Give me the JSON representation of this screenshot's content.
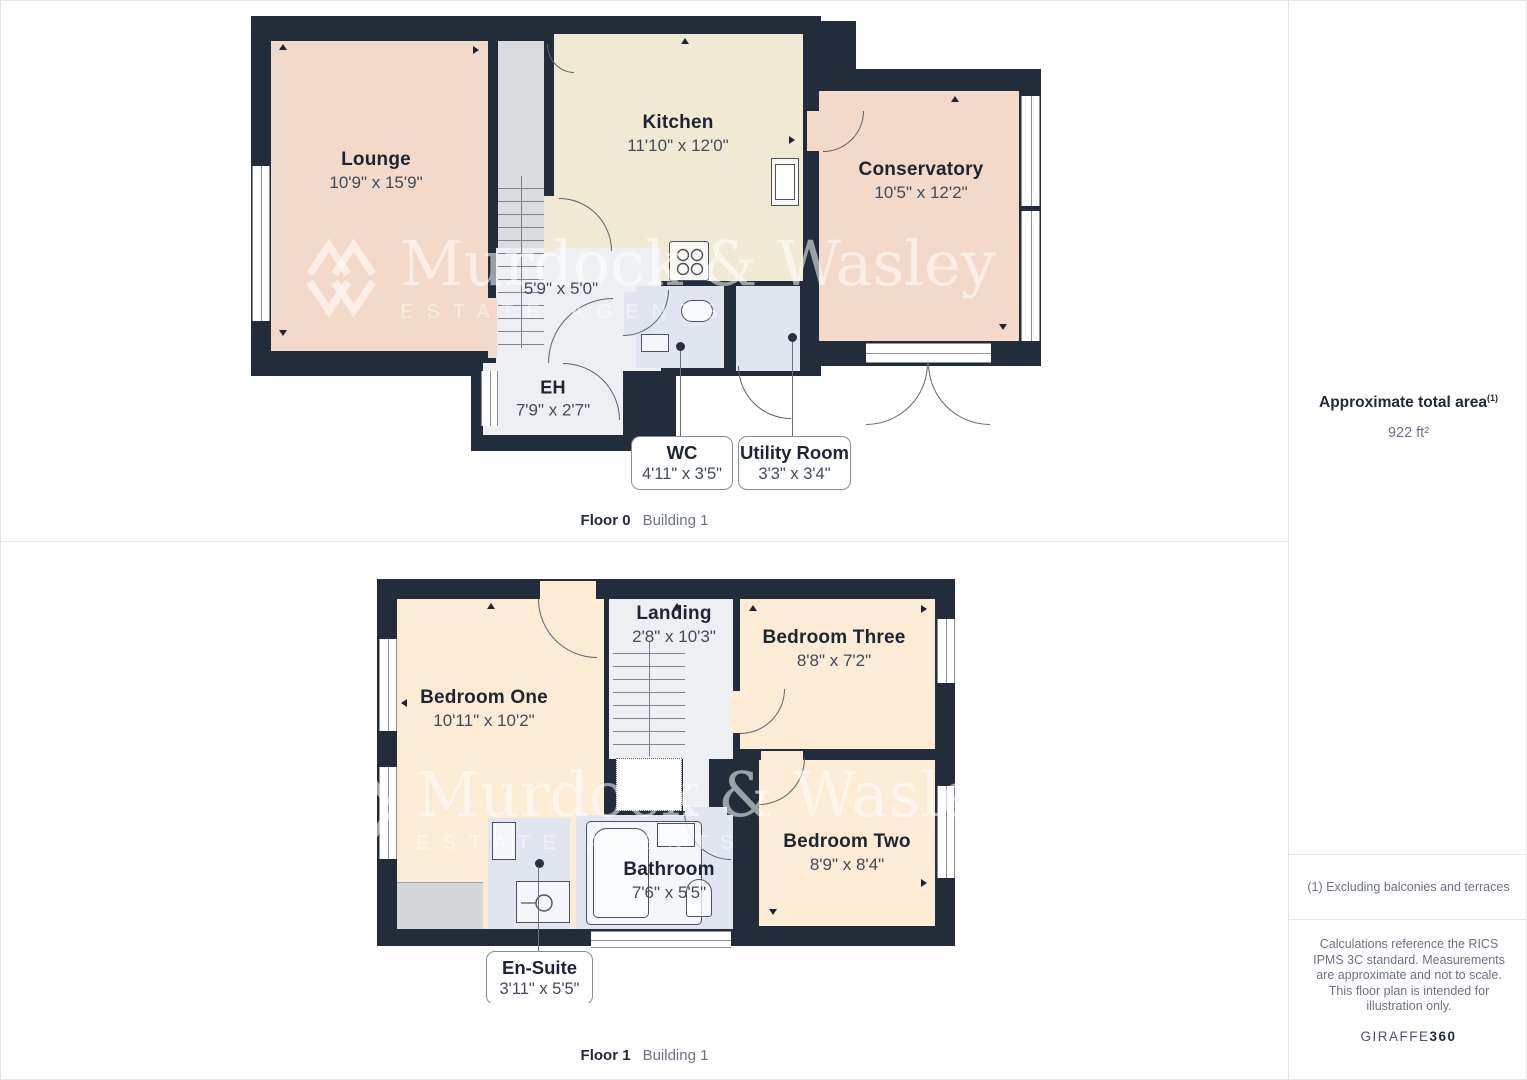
{
  "colors": {
    "wall": "#232C3B",
    "pink": "#F3D9C9",
    "cream": "#F0EAD4",
    "peach": "#FCEBD5",
    "room-gray": "#EDEFF2",
    "room-blue": "#E0E5F0",
    "stair-gray": "#D9DBDE",
    "wardrobe-gray": "#D4D6D9",
    "label-navy": "#1D2534",
    "label-dim": "#414B5A",
    "muted": "#6B7280",
    "line": "#E3E5E7",
    "door-line": "#5B6472",
    "fix-line": "#4A5264"
  },
  "watermark": {
    "name": "Murdock & Wasley",
    "subtitle": "ESTATE AGENTS"
  },
  "floor0": {
    "caption": "Floor 0",
    "building": "Building 1",
    "rooms": {
      "lounge": {
        "name": "Lounge",
        "dims": "10'9\" x 15'9\""
      },
      "kitchen": {
        "name": "Kitchen",
        "dims": "11'10\" x 12'0\""
      },
      "conservatory": {
        "name": "Conservatory",
        "dims": "10'5\" x 12'2\""
      },
      "hall": {
        "dims": "5'9\" x 5'0\""
      },
      "eh": {
        "name": "EH",
        "dims": "7'9\" x 2'7\""
      },
      "wc": {
        "name": "WC",
        "dims": "4'11\" x 3'5\""
      },
      "utility": {
        "name": "Utility Room",
        "dims": "3'3\" x 3'4\""
      }
    }
  },
  "floor1": {
    "caption": "Floor 1",
    "building": "Building 1",
    "rooms": {
      "bedroom_one": {
        "name": "Bedroom One",
        "dims": "10'11\" x 10'2\""
      },
      "landing": {
        "name": "Landing",
        "dims": "2'8\" x 10'3\""
      },
      "bedroom_three": {
        "name": "Bedroom Three",
        "dims": "8'8\" x 7'2\""
      },
      "bedroom_two": {
        "name": "Bedroom Two",
        "dims": "8'9\" x 8'4\""
      },
      "bathroom": {
        "name": "Bathroom",
        "dims": "7'6\" x 5'5\""
      },
      "ensuite": {
        "name": "En-Suite",
        "dims": "3'11\" x 5'5\""
      }
    }
  },
  "sidebar": {
    "area_title": "Approximate total area",
    "area_sup": "(1)",
    "area_value": "922 ft²",
    "footnote": "(1) Excluding balconies and terraces",
    "disclaimer": "Calculations reference the RICS IPMS 3C standard. Measurements are approximate and not to scale. This floor plan is intended for illustration only.",
    "brand": "GIRAFFE",
    "brand_suffix": "360"
  }
}
